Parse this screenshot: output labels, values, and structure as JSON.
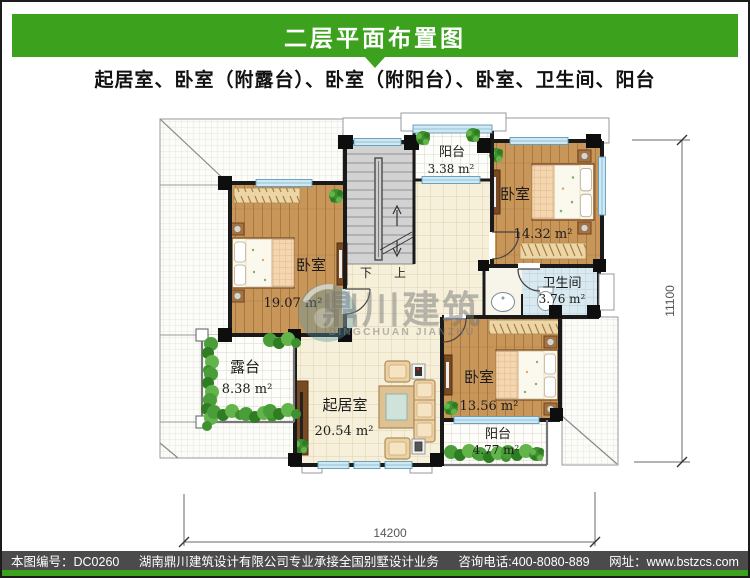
{
  "header": {
    "title": "二层平面布置图",
    "subtitle": "起居室、卧室（附露台）、卧室（附阳台）、卧室、卫生间、阳台"
  },
  "colors": {
    "accent_green": "#3ca21e",
    "footer_bar": "#4b4b4b",
    "wall_black": "#1a1a1a",
    "wood_floor": "#c9965a",
    "tile_cream": "#f6f0da",
    "tile_bath": "#d9e9ef",
    "stair_gray": "#d2d2d2",
    "window_blue": "#cfe8f2",
    "greenery": "#4a9e3a"
  },
  "plan": {
    "rooms": {
      "bedroom_nw": {
        "name": "卧室",
        "area": "19.07 m²"
      },
      "bedroom_ne": {
        "name": "卧室",
        "area": "14.32 m²"
      },
      "bedroom_se": {
        "name": "卧室",
        "area": "13.56 m²"
      },
      "living": {
        "name": "起居室",
        "area": "20.54 m²"
      },
      "bath": {
        "name": "卫生间",
        "area": "3.76 m²"
      },
      "balcony_top": {
        "name": "阳台",
        "area": "3.38 m²"
      },
      "balcony_bottom": {
        "name": "阳台",
        "area": "4.77 m²"
      },
      "terrace": {
        "name": "露台",
        "area": "8.38 m²"
      }
    },
    "stairs": {
      "down": "下",
      "up": "上"
    },
    "dimensions": {
      "width": "14200",
      "height": "11100"
    },
    "watermark": {
      "cn": "鼎川建筑",
      "en": "DINGCHUAN JIANZHU"
    }
  },
  "footer": {
    "serial": "本图编号：DC0260",
    "company": "湖南鼎川建筑设计有限公司专业承接全国别墅设计业务",
    "phone": "咨询电话:400-8080-889",
    "website": "网址：www.bstzcs.com"
  }
}
